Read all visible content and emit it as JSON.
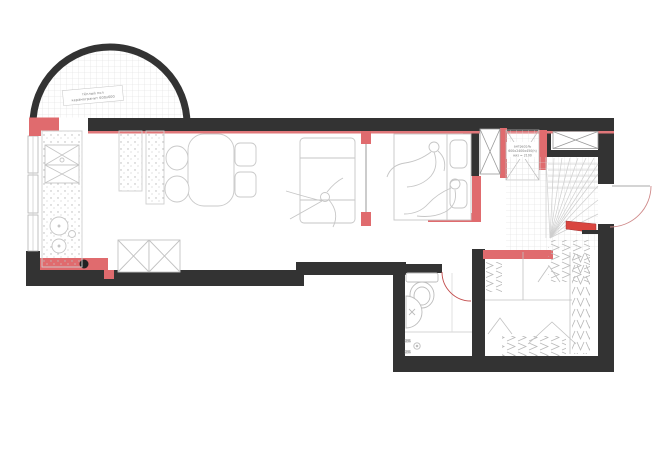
{
  "page": {
    "background": "#ffffff"
  },
  "colors": {
    "existing_wall": "#333333",
    "new_partition": "#e06b6e",
    "accent_red": "#d9453f",
    "furniture_line": "#c6c6c6",
    "tile_line": "#dedede",
    "label_text": "#7a7a7a"
  },
  "labels": {
    "balcony_floor": {
      "line1": "тёплый пол",
      "line2": "керамогранит 600х600"
    },
    "mezzanine": {
      "line1": "антресоль",
      "line2": "600х2400х450(h)",
      "line3": "низ = 2100"
    },
    "shower_slope_top": "2%",
    "shower_slope_bottom": "2%"
  }
}
